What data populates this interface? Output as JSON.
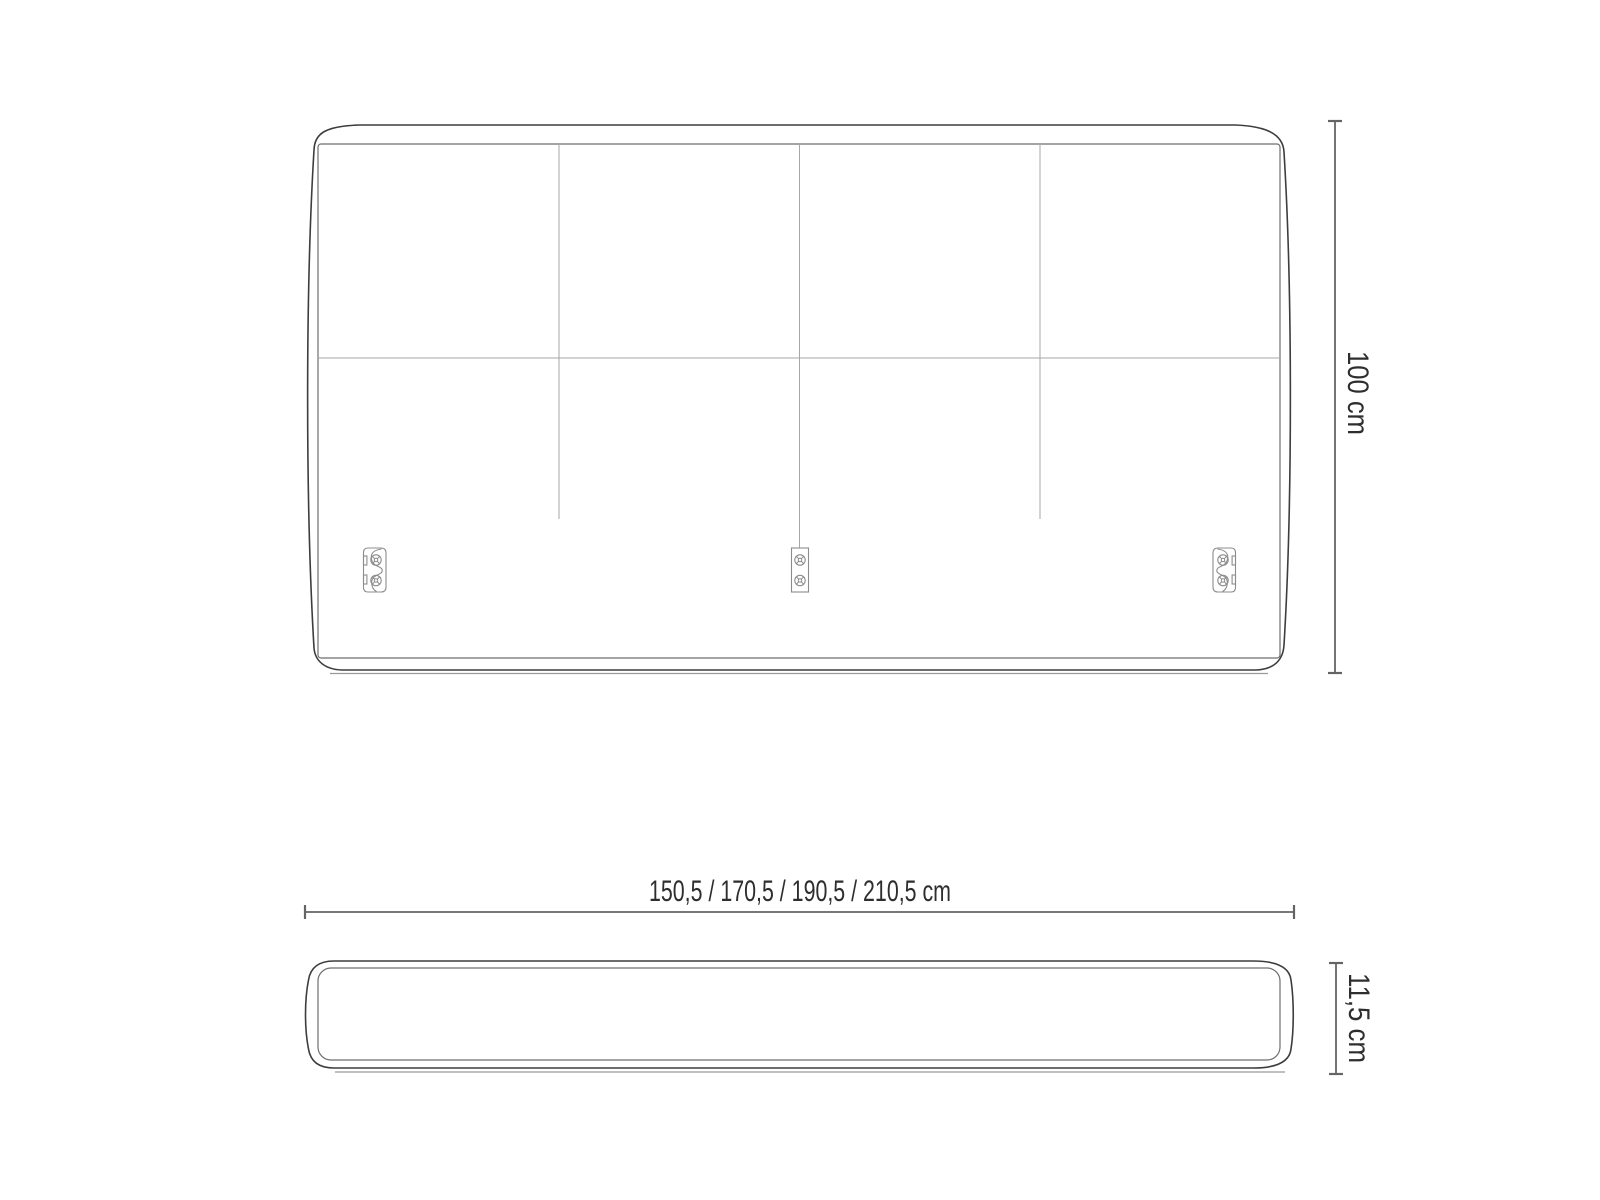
{
  "drawing": {
    "subject": "headboard technical dimension drawing",
    "views": {
      "front_view": {
        "name": "front elevation",
        "panel_columns": 4,
        "panel_rows": 2,
        "bracket_count": 3
      },
      "top_view": {
        "name": "plan view"
      }
    },
    "dimensions": {
      "height_label": "100 cm",
      "width_label": "150,5 / 170,5 / 190,5 / 210,5 cm",
      "depth_label": "11,5 cm"
    },
    "colors": {
      "background": "#ffffff",
      "outline": "#3d3d3d",
      "panel_line": "#6e6e6e",
      "seam_line": "#a7a7a7",
      "bracket_line": "#8c8c8c",
      "dimension_line": "#646464",
      "text": "#2e2e2e"
    }
  }
}
